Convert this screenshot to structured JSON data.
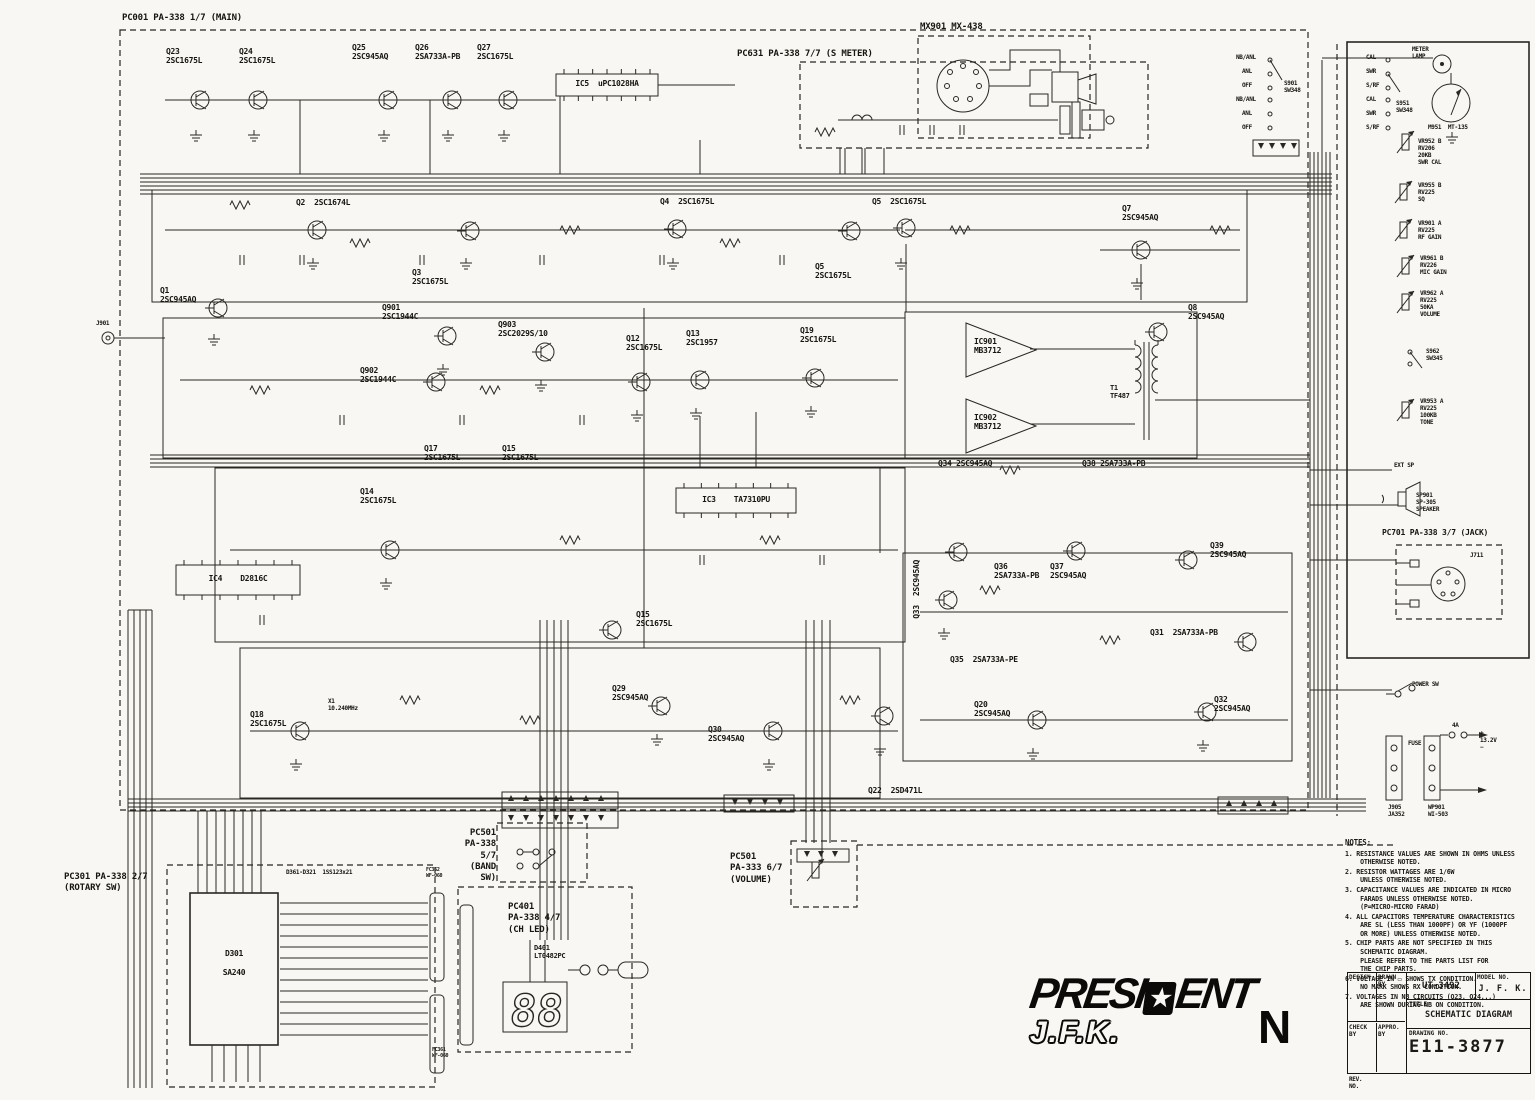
{
  "doc_title": "President J.F.K. CB Radio Schematic",
  "boards": {
    "main": "PC001 PA-338 1/7 (MAIN)",
    "smeter": "PC631 PA-338 7/7 (S METER)",
    "mic": "MX901 MX-438",
    "rotary": "PC301 PA-338 2/7\n(ROTARY SW)",
    "band": "PC501\nPA-338 5/7\n(BAND SW)",
    "chled": "PC401\nPA-338 4/7\n(CH LED)",
    "volume": "PC501\nPA-333 6/7\n(VOLUME)",
    "jack": "PC701 PA-338 3/7 (JACK)"
  },
  "logo": {
    "p1": "PRESI",
    "star": "★",
    "p2": "ENT",
    "sub": "J.F.K.",
    "rev": "N"
  },
  "titleblock": {
    "design": "DESIGN",
    "drawn": "DRAWN BY",
    "check": "CHECK BY",
    "appro": "APPRO. BY",
    "doc": "UT-3492",
    "model_label": "MODEL NO.",
    "model": "J. F. K.",
    "title_label": "TITLE",
    "title": "SCHEMATIC DIAGRAM",
    "drawing_label": "DRAWING NO.",
    "drawing": "E11-3877",
    "rev_label": "REV.\nNO."
  },
  "notes": {
    "heading": "NOTES:",
    "items": [
      "1. RESISTANCE VALUES ARE SHOWN IN OHMS UNLESS\n    OTHERWISE NOTED.",
      "2. RESISTOR WATTAGES ARE 1/6W\n    UNLESS OTHERWISE NOTED.",
      "3. CAPACITANCE VALUES ARE INDICATED IN MICRO\n    FARADS UNLESS OTHERWISE NOTED.\n    (P=MICRO-MICRO FARAD)",
      "4. ALL CAPACITORS TEMPERATURE CHARACTERISTICS\n    ARE SL (LESS THAN 1000PF) OR YF (1000PF\n    OR MORE) UNLESS OTHERWISE NOTED.",
      "5. CHIP PARTS ARE NOT SPECIFIED IN THIS\n    SCHEMATIC DIAGRAM.\n    PLEASE REFER TO THE PARTS LIST FOR\n    THE CHIP PARTS.",
      "6. VOLTAGE IN ▭ SHOWS TX CONDITION.\n    NO MARK SHOWS RX CONDITION.",
      "7. VOLTAGES IN NB CIRCUITS (Q23, Q24...)\n    ARE SHOWN DURING NB ON CONDITION."
    ]
  },
  "components": [
    {
      "id": "Q23",
      "t": "Q23\n2SC1675L",
      "x": 166,
      "y": 47,
      "k": "npn",
      "gx": 200,
      "gy": 100
    },
    {
      "id": "Q24",
      "t": "Q24\n2SC1675L",
      "x": 239,
      "y": 47,
      "k": "npn",
      "gx": 258,
      "gy": 100
    },
    {
      "id": "Q25",
      "t": "Q25\n2SC945AQ",
      "x": 352,
      "y": 43,
      "k": "npn",
      "gx": 388,
      "gy": 100
    },
    {
      "id": "Q26",
      "t": "Q26\n2SA733A-PB",
      "x": 415,
      "y": 43,
      "k": "npn",
      "gx": 452,
      "gy": 100
    },
    {
      "id": "Q27",
      "t": "Q27\n2SC1675L",
      "x": 477,
      "y": 43,
      "k": "npn",
      "gx": 508,
      "gy": 100
    },
    {
      "id": "IC5",
      "t": "IC5  uPC1028HA",
      "k": "ic",
      "bx": 556,
      "by": 74,
      "bw": 102,
      "bh": 22
    },
    {
      "id": "Q1",
      "t": "Q1\n2SC945AQ",
      "x": 160,
      "y": 286,
      "k": "npn",
      "gx": 218,
      "gy": 308
    },
    {
      "id": "Q2",
      "t": "Q2  2SC1674L",
      "x": 296,
      "y": 198,
      "k": "npn",
      "gx": 317,
      "gy": 230
    },
    {
      "id": "Q3",
      "t": "Q3\n2SC1675L",
      "x": 412,
      "y": 268,
      "k": "npn",
      "gx": 470,
      "gy": 231
    },
    {
      "id": "Q4",
      "t": "Q4  2SC1675L",
      "x": 660,
      "y": 197,
      "k": "npn",
      "gx": 677,
      "gy": 229
    },
    {
      "id": "Q5",
      "t": "Q5  2SC1675L",
      "x": 872,
      "y": 197,
      "k": "npn",
      "gx": 906,
      "gy": 228
    },
    {
      "id": "Q5m",
      "t": "Q5\n2SC1675L",
      "x": 815,
      "y": 262,
      "k": "npn",
      "gx": 851,
      "gy": 231
    },
    {
      "id": "Q7",
      "t": "Q7\n2SC945AQ",
      "x": 1122,
      "y": 204,
      "k": "npn",
      "gx": 1141,
      "gy": 250
    },
    {
      "id": "Q8",
      "t": "Q8\n2SC945AQ",
      "x": 1188,
      "y": 303,
      "k": "npn",
      "gx": 1158,
      "gy": 332
    },
    {
      "id": "Q901",
      "t": "Q901\n2SC1944C",
      "x": 382,
      "y": 303,
      "k": "npn",
      "gx": 447,
      "gy": 336
    },
    {
      "id": "Q902",
      "t": "Q902\n2SC1944C",
      "x": 360,
      "y": 366,
      "k": "npn",
      "gx": 436,
      "gy": 382
    },
    {
      "id": "Q903",
      "t": "Q903\n2SC2029S/10",
      "x": 498,
      "y": 320,
      "k": "npn",
      "gx": 545,
      "gy": 352
    },
    {
      "id": "Q12",
      "t": "Q12\n2SC1675L",
      "x": 626,
      "y": 334,
      "k": "npn",
      "gx": 641,
      "gy": 382
    },
    {
      "id": "Q13",
      "t": "Q13\n2SC1957",
      "x": 686,
      "y": 329,
      "k": "npn",
      "gx": 700,
      "gy": 380
    },
    {
      "id": "Q19",
      "t": "Q19\n2SC1675L",
      "x": 800,
      "y": 326,
      "k": "npn",
      "gx": 815,
      "gy": 378
    },
    {
      "id": "IC901",
      "t": "IC901\nMB3712",
      "x": 974,
      "y": 337,
      "k": "amp"
    },
    {
      "id": "IC902",
      "t": "IC902\nMB3712",
      "x": 974,
      "y": 413,
      "k": "amp"
    },
    {
      "id": "T1",
      "t": "T1\nTF487",
      "x": 1110,
      "y": 384,
      "fs": 7
    },
    {
      "id": "Q34",
      "t": "Q34 2SC945AQ",
      "x": 938,
      "y": 459
    },
    {
      "id": "Q38",
      "t": "Q38 2SA733A-PB",
      "x": 1082,
      "y": 459
    },
    {
      "id": "Q17",
      "t": "Q17\n2SC1675L",
      "x": 424,
      "y": 444
    },
    {
      "id": "Q15",
      "t": "Q15\n2SC1675L",
      "x": 502,
      "y": 444
    },
    {
      "id": "Q14",
      "t": "Q14\n2SC1675L",
      "x": 360,
      "y": 487,
      "k": "npn",
      "gx": 390,
      "gy": 550
    },
    {
      "id": "IC3",
      "t": "IC3    TA7310PU",
      "k": "ic",
      "bx": 676,
      "by": 488,
      "bw": 120,
      "bh": 25
    },
    {
      "id": "IC4",
      "t": "IC4    D2816C",
      "k": "ic",
      "bx": 176,
      "by": 565,
      "bw": 124,
      "bh": 30
    },
    {
      "id": "Q15b",
      "t": "Q15\n2SC1675L",
      "x": 636,
      "y": 610,
      "k": "npn",
      "gx": 612,
      "gy": 630
    },
    {
      "id": "Q33",
      "t": "Q33  2SC945AQ",
      "x": 912,
      "y": 560,
      "k": "vlbl",
      "gx": 948,
      "gy": 600
    },
    {
      "id": "Q36",
      "t": "Q36\n2SA733A-PB",
      "x": 994,
      "y": 562,
      "k": "npn",
      "gx": 958,
      "gy": 552
    },
    {
      "id": "Q37",
      "t": "Q37\n2SC945AQ",
      "x": 1050,
      "y": 562,
      "k": "npn",
      "gx": 1076,
      "gy": 551
    },
    {
      "id": "Q39",
      "t": "Q39\n2SC945AQ",
      "x": 1210,
      "y": 541,
      "k": "npn",
      "gx": 1188,
      "gy": 560
    },
    {
      "id": "Q31",
      "t": "Q31  2SA733A-PB",
      "x": 1150,
      "y": 628,
      "k": "npn",
      "gx": 1247,
      "gy": 642
    },
    {
      "id": "Q35",
      "t": "Q35  2SA733A-PE",
      "x": 950,
      "y": 655
    },
    {
      "id": "Q20",
      "t": "Q20\n2SC945AQ",
      "x": 974,
      "y": 700,
      "k": "npn",
      "gx": 1037,
      "gy": 720
    },
    {
      "id": "Q32",
      "t": "Q32\n2SC945AQ",
      "x": 1214,
      "y": 695,
      "k": "npn",
      "gx": 1207,
      "gy": 712
    },
    {
      "id": "Q18",
      "t": "Q18\n2SC1675L",
      "x": 250,
      "y": 710,
      "k": "npn",
      "gx": 300,
      "gy": 731
    },
    {
      "id": "X1",
      "t": "X1\n10.240MHz",
      "x": 328,
      "y": 698,
      "fs": 6
    },
    {
      "id": "Q29",
      "t": "Q29\n2SC945AQ",
      "x": 612,
      "y": 684,
      "k": "npn",
      "gx": 661,
      "gy": 706
    },
    {
      "id": "Q30",
      "t": "Q30\n2SC945AQ",
      "x": 708,
      "y": 725,
      "k": "npn",
      "gx": 773,
      "gy": 731
    },
    {
      "id": "Q22",
      "t": "Q22  2SD471L",
      "x": 868,
      "y": 786,
      "k": "npn",
      "gx": 884,
      "gy": 716
    },
    {
      "id": "D361",
      "t": "D361-D321  1SS123x21",
      "x": 286,
      "y": 869,
      "fs": 6
    },
    {
      "id": "D301",
      "t": "D301\n\nSA240",
      "k": "blk",
      "bx": 190,
      "by": 893,
      "bw": 88,
      "bh": 152
    },
    {
      "id": "D401",
      "t": "D401\nLT0482PC",
      "x": 534,
      "y": 944,
      "fs": 7
    },
    {
      "id": "FC362",
      "t": "FC362\nWF-060",
      "x": 426,
      "y": 868,
      "fs": 5
    },
    {
      "id": "FC361",
      "t": "FC361\nWF-060",
      "x": 432,
      "y": 1048,
      "fs": 5
    },
    {
      "id": "J901",
      "t": "J901",
      "x": 96,
      "y": 320,
      "fs": 6
    },
    {
      "id": "S901",
      "t": "S901\nSW348",
      "x": 1284,
      "y": 80,
      "fs": 6
    },
    {
      "id": "S951",
      "t": "S951\nSW348",
      "x": 1396,
      "y": 100,
      "fs": 6
    },
    {
      "id": "S901p1",
      "t": "NB/ANL",
      "x": 1236,
      "y": 54,
      "fs": 6
    },
    {
      "id": "S901p2",
      "t": "ANL",
      "x": 1242,
      "y": 68,
      "fs": 6
    },
    {
      "id": "S901p3",
      "t": "OFF",
      "x": 1242,
      "y": 82,
      "fs": 6
    },
    {
      "id": "S901p4",
      "t": "NB/ANL",
      "x": 1236,
      "y": 96,
      "fs": 6
    },
    {
      "id": "S901p5",
      "t": "ANL",
      "x": 1242,
      "y": 110,
      "fs": 6
    },
    {
      "id": "S901p6",
      "t": "OFF",
      "x": 1242,
      "y": 124,
      "fs": 6
    },
    {
      "id": "S951p1",
      "t": "CAL",
      "x": 1366,
      "y": 54,
      "fs": 6
    },
    {
      "id": "S951p2",
      "t": "SWR",
      "x": 1366,
      "y": 68,
      "fs": 6
    },
    {
      "id": "S951p3",
      "t": "S/RF",
      "x": 1366,
      "y": 82,
      "fs": 6
    },
    {
      "id": "S951p4",
      "t": "CAL",
      "x": 1366,
      "y": 96,
      "fs": 6
    },
    {
      "id": "S951p5",
      "t": "SWR",
      "x": 1366,
      "y": 110,
      "fs": 6
    },
    {
      "id": "S951p6",
      "t": "S/RF",
      "x": 1366,
      "y": 124,
      "fs": 6
    },
    {
      "id": "MLAMP",
      "t": "METER\nLAMP",
      "x": 1412,
      "y": 46,
      "fs": 6
    },
    {
      "id": "M951",
      "t": "M951  MT-135",
      "x": 1428,
      "y": 124,
      "fs": 6
    },
    {
      "id": "VR952",
      "t": "VR952 B\nRV206\n20KB\nSWR CAL",
      "x": 1418,
      "y": 138,
      "fs": 6
    },
    {
      "id": "VR955",
      "t": "VR955 B\nRV225\nSQ",
      "x": 1418,
      "y": 182,
      "fs": 6
    },
    {
      "id": "VR901",
      "t": "VR901 A\nRV225\nRF GAIN",
      "x": 1418,
      "y": 220,
      "fs": 6
    },
    {
      "id": "VR961",
      "t": "VR961 B\nRV226\nMIC GAIN",
      "x": 1420,
      "y": 255,
      "fs": 6
    },
    {
      "id": "VR962",
      "t": "VR962 A\nRV225\n50KA\nVOLUME",
      "x": 1420,
      "y": 290,
      "fs": 6
    },
    {
      "id": "S962",
      "t": "S962\nSW345",
      "x": 1426,
      "y": 348,
      "fs": 6
    },
    {
      "id": "VR953",
      "t": "VR953 A\nRV225\n100KB\nTONE",
      "x": 1420,
      "y": 398,
      "fs": 6
    },
    {
      "id": "EXTSP",
      "t": "EXT SP",
      "x": 1394,
      "y": 462,
      "fs": 6
    },
    {
      "id": "SP901",
      "t": "SP901\nSP-305\nSPEAKER",
      "x": 1416,
      "y": 492,
      "fs": 6
    },
    {
      "id": "J711",
      "t": "J711",
      "x": 1470,
      "y": 552,
      "fs": 6
    },
    {
      "id": "PWR",
      "t": "POWER SW",
      "x": 1412,
      "y": 681,
      "fs": 6
    },
    {
      "id": "FUSE",
      "t": "FUSE",
      "x": 1408,
      "y": 740,
      "fs": 6
    },
    {
      "id": "F4A",
      "t": "4A",
      "x": 1452,
      "y": 722,
      "fs": 6
    },
    {
      "id": "V132",
      "t": "+\n13.2V\n−",
      "x": 1480,
      "y": 730,
      "fs": 6
    },
    {
      "id": "J905",
      "t": "J905\nJA352",
      "x": 1388,
      "y": 804,
      "fs": 6
    },
    {
      "id": "WP901",
      "t": "WP901\nWI-503",
      "x": 1428,
      "y": 804,
      "fs": 6
    }
  ]
}
